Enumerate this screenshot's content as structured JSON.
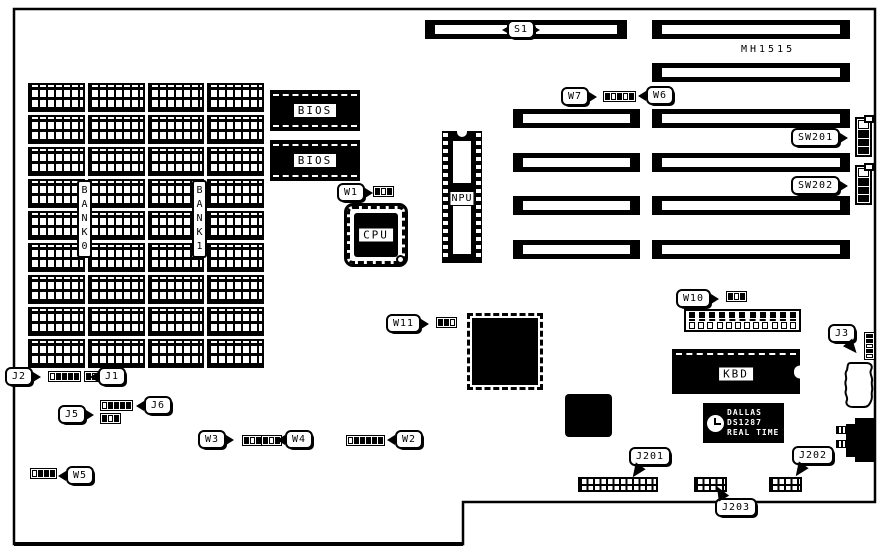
{
  "board": {
    "model": "MH1515"
  },
  "memory": {
    "rows": 9,
    "columns": 4,
    "chip_count": 36,
    "bank0_label": "BANK0",
    "bank1_label": "BANK1"
  },
  "chips": {
    "bios_top": "BIOS",
    "bios_bottom": "BIOS",
    "cpu": "CPU",
    "npu": "NPU",
    "kbd": "KBD",
    "rtc": {
      "brand": "DALLAS",
      "part": "DS1287",
      "type": "REAL TIME"
    }
  },
  "power_connector": {
    "top_pins": 11,
    "bottom_pins": 12
  },
  "callouts": {
    "s1": "S1",
    "w1": "W1",
    "w2": "W2",
    "w3": "W3",
    "w4": "W4",
    "w5": "W5",
    "w6": "W6",
    "w7": "W7",
    "w10": "W10",
    "w11": "W11",
    "j1": "J1",
    "j2": "J2",
    "j3": "J3",
    "j5": "J5",
    "j6": "J6",
    "j201": "J201",
    "j202": "J202",
    "j203": "J203",
    "sw201": "SW201",
    "sw202": "SW202"
  },
  "colors": {
    "ink": "#000000",
    "paper": "#ffffff"
  }
}
